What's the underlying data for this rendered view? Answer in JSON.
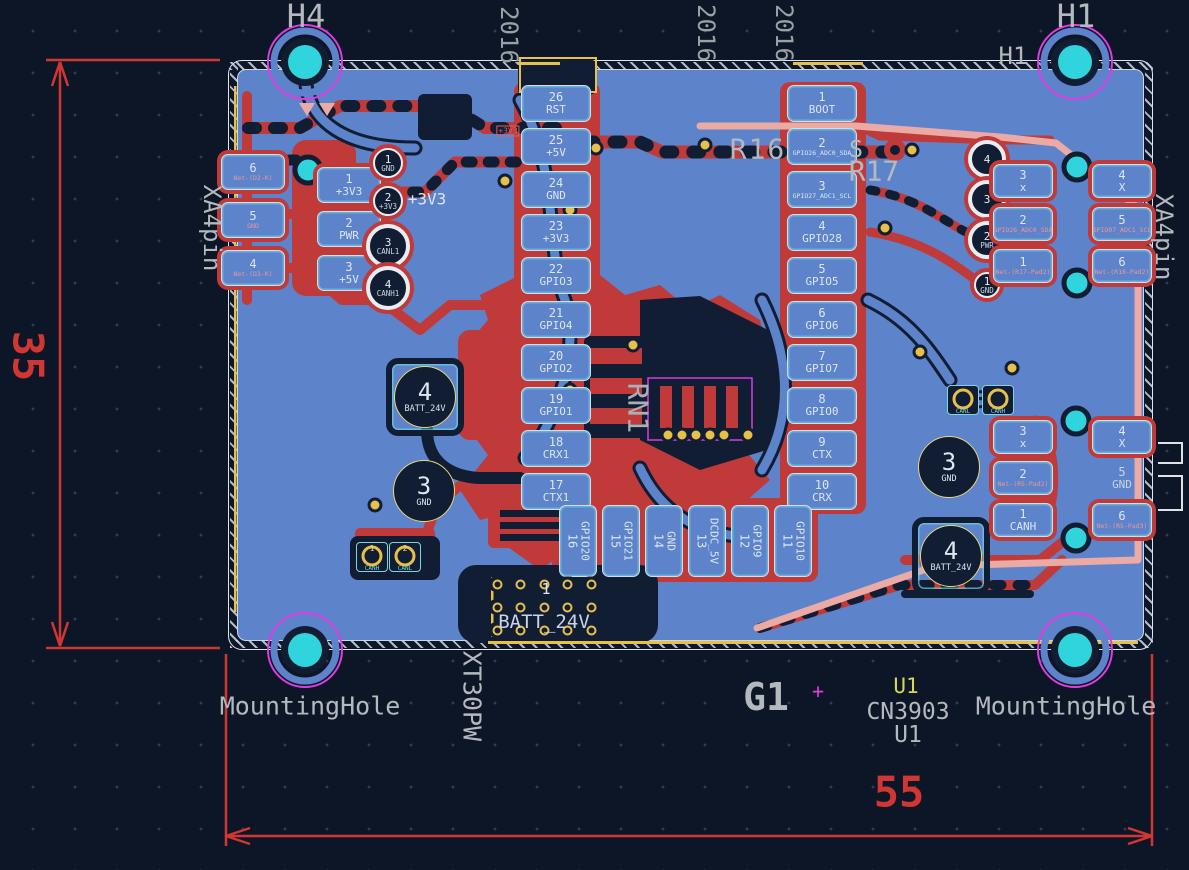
{
  "titles": {
    "h4": "H4",
    "h1": "H1",
    "h1_small": "H1"
  },
  "top_labels": [
    "2016",
    "2016",
    "2016"
  ],
  "mounting": {
    "left": "MountingHole",
    "right": "MountingHole"
  },
  "dimensions": {
    "height": "35",
    "width": "55"
  },
  "refs": {
    "r16": "R16",
    "r17": "R17",
    "r17_s": "S",
    "rn1": "RN1",
    "g1": "G1",
    "g1_cross": "+",
    "u1_value": "U1",
    "u1_part": "CN3903",
    "u1_ref": "U1"
  },
  "nets": {
    "v3_left": "+3V3",
    "v3_right": "+3V3"
  },
  "left_header": {
    "pins": [
      {
        "num": "26",
        "name": "RST"
      },
      {
        "num": "25",
        "name": "+5V"
      },
      {
        "num": "24",
        "name": "GND"
      },
      {
        "num": "23",
        "name": "+3V3"
      },
      {
        "num": "22",
        "name": "GPIO3"
      },
      {
        "num": "21",
        "name": "GPIO4"
      },
      {
        "num": "20",
        "name": "GPIO2"
      },
      {
        "num": "19",
        "name": "GPIO1"
      },
      {
        "num": "18",
        "name": "CRX1"
      },
      {
        "num": "17",
        "name": "CTX1"
      }
    ]
  },
  "bottom_header": {
    "pins": [
      {
        "num": "16",
        "name": "GPIO20"
      },
      {
        "num": "15",
        "name": "GPIO21"
      },
      {
        "num": "14",
        "name": "GND"
      },
      {
        "num": "13",
        "name": "DCDC_5V"
      },
      {
        "num": "12",
        "name": "GPIO9"
      },
      {
        "num": "11",
        "name": "GPIO10"
      }
    ]
  },
  "right_header": {
    "pins": [
      {
        "num": "1",
        "name": "BOOT"
      },
      {
        "num": "2",
        "name": "GPIO26_ADC0_SDA"
      },
      {
        "num": "3",
        "name": "GPIO27_ADC1_SCL"
      },
      {
        "num": "4",
        "name": "GPIO28"
      },
      {
        "num": "5",
        "name": "GPIO5"
      },
      {
        "num": "6",
        "name": "GPIO6"
      },
      {
        "num": "7",
        "name": "GPIO7"
      },
      {
        "num": "8",
        "name": "GPIO0"
      },
      {
        "num": "9",
        "name": "CTX"
      },
      {
        "num": "10",
        "name": "CRX"
      }
    ]
  },
  "left_conn": {
    "label": "XA4pin",
    "edge_pads": [
      {
        "num": "6",
        "name": "Net-(D2-K)"
      },
      {
        "num": "5",
        "name": "GND"
      },
      {
        "num": "4",
        "name": "Net-(D3-K)"
      }
    ],
    "mid_pads": [
      {
        "num": "1",
        "name": "+3V3"
      },
      {
        "num": "2",
        "name": "PWR"
      },
      {
        "num": "3",
        "name": "+5V"
      }
    ],
    "th_pads": [
      {
        "num": "1",
        "name": "GND"
      },
      {
        "num": "2",
        "name": "+3V3"
      },
      {
        "num": "3",
        "name": "CANL1"
      },
      {
        "num": "4",
        "name": "CANH1"
      }
    ]
  },
  "right_conn": {
    "label": "XA4pin",
    "th_pads": [
      {
        "num": "4",
        "name": ""
      },
      {
        "num": "3",
        "name": ""
      },
      {
        "num": "2",
        "name": "PWR"
      },
      {
        "num": "1",
        "name": "GND"
      }
    ],
    "mid_pads": [
      {
        "num": "3",
        "name": "x"
      },
      {
        "num": "2",
        "name": "GPIO26_ADC0_SDA"
      },
      {
        "num": "1",
        "name": "Net-(R17-Pad2)"
      }
    ],
    "outer_pads": [
      {
        "num": "4",
        "name": "X"
      },
      {
        "num": "5",
        "name": "GPIO07_ADC1_SCL"
      },
      {
        "num": "6",
        "name": "Net-(R18-Pad2)"
      }
    ]
  },
  "br_conn": {
    "mid_pads": [
      {
        "num": "3",
        "name": "x"
      },
      {
        "num": "2",
        "name": "Net-(R5-Pad2)"
      },
      {
        "num": "1",
        "name": "CANH"
      }
    ],
    "outer_pads": [
      {
        "num": "4",
        "name": "X"
      },
      {
        "num": "5",
        "name": "GND"
      },
      {
        "num": "6",
        "name": "Net-(R5-Pad3)"
      }
    ],
    "pair": [
      {
        "num": "",
        "name": "CANL"
      },
      {
        "num": "",
        "name": "CANH"
      }
    ],
    "pair_mark": "3"
  },
  "bl_pair": [
    {
      "num": "1",
      "name": "CANH"
    },
    {
      "num": "2",
      "name": "CANL"
    }
  ],
  "big_pads": [
    {
      "num": "4",
      "name": "BATT_24V"
    },
    {
      "num": "3",
      "name": "GND"
    },
    {
      "num": "3",
      "name": "GND"
    },
    {
      "num": "4",
      "name": "BATT_24V"
    }
  ],
  "batt_conn": {
    "num": "1",
    "name": "BATT_24V",
    "side_label": "XT30PW"
  }
}
